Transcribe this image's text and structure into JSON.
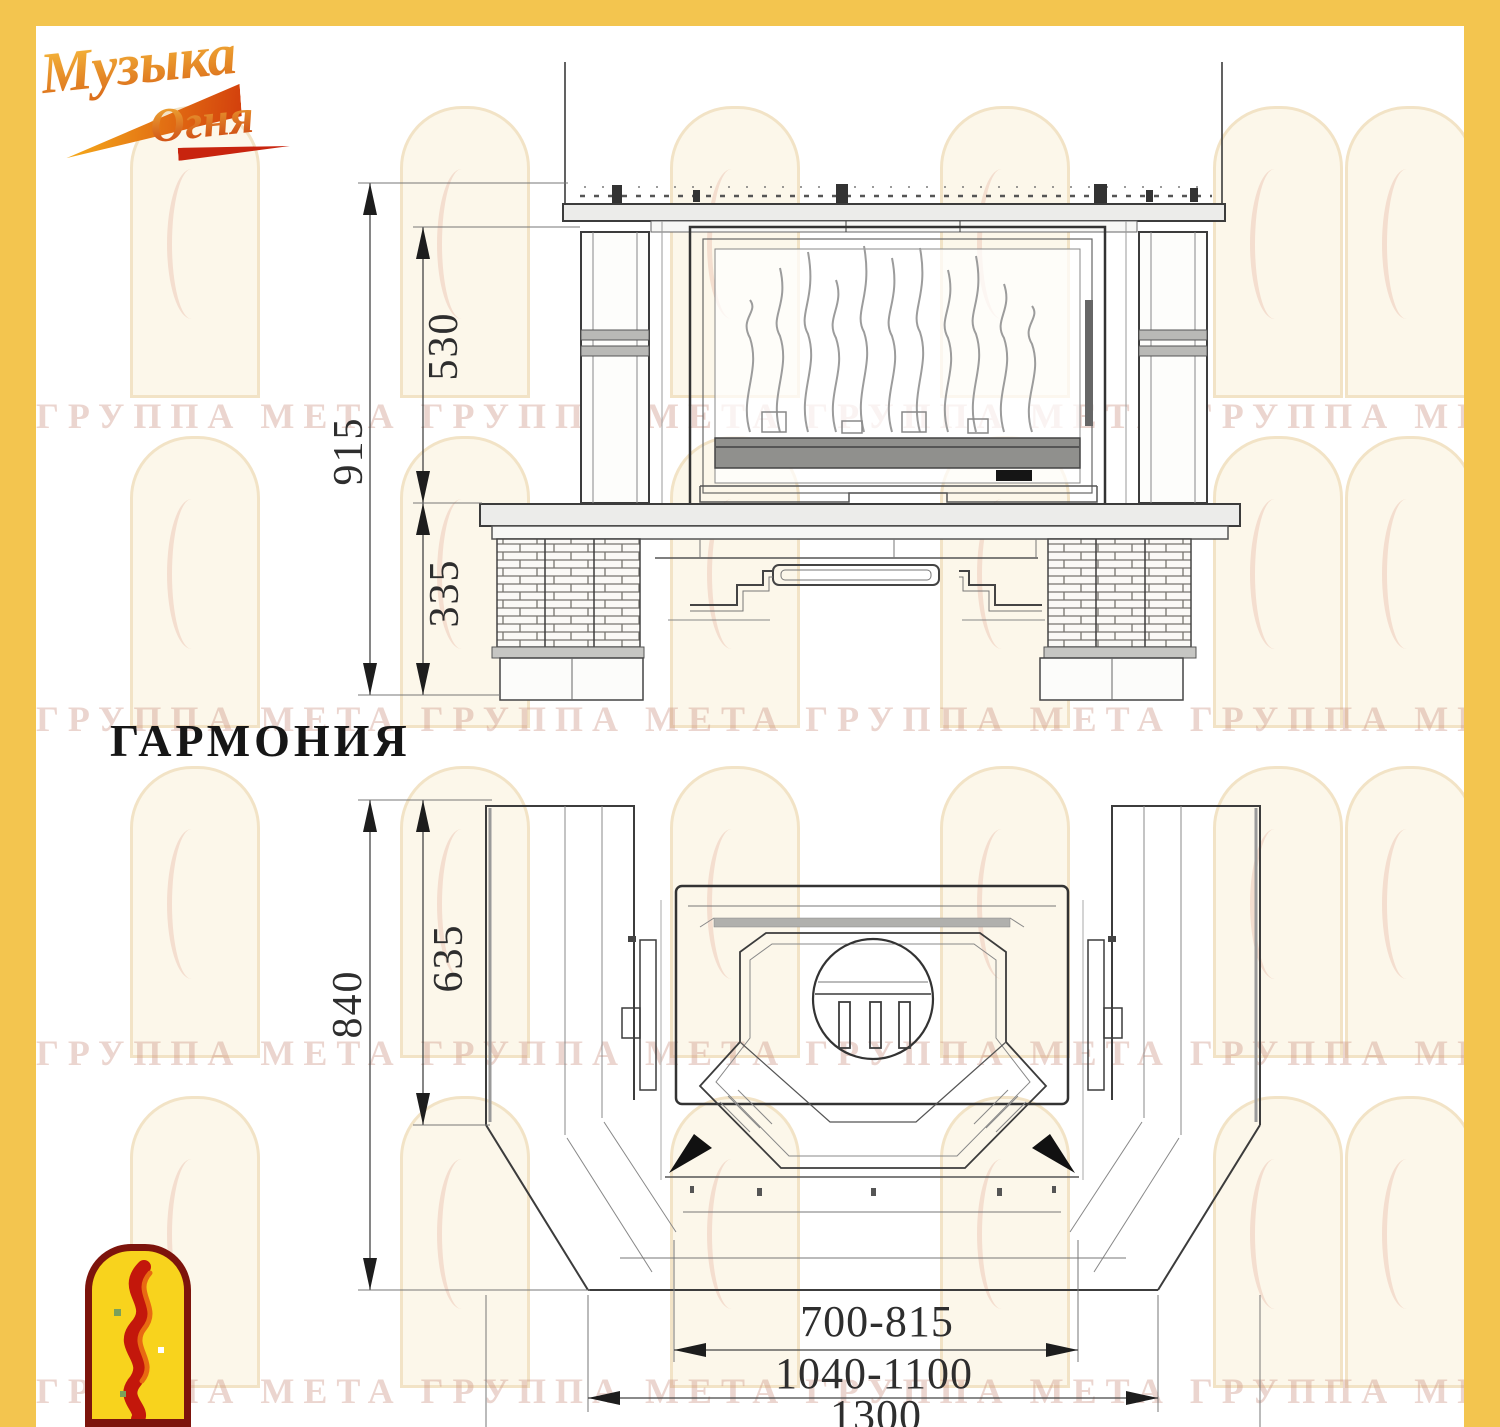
{
  "model": {
    "title": "ГАРМОНИЯ"
  },
  "brand_logo": {
    "word1": "Музыка",
    "word2": "Огня"
  },
  "front_view": {
    "name": "front elevation of fireplace",
    "dimensions": {
      "total_height": "915",
      "firebox_height": "530",
      "base_height": "335"
    }
  },
  "plan_view": {
    "name": "top plan of fireplace",
    "dimensions": {
      "total_depth": "840",
      "wall_depth": "635",
      "firebox_width_range": "700-815",
      "inner_width_range": "1040-1100",
      "total_width": "1300"
    }
  },
  "watermark": {
    "row_text": "ГРУППА МЕТА ГРУППА МЕТА ГРУППА МЕТА ГРУППА МЕТА ГРУППА МЕТА",
    "tile": "arched-window"
  },
  "colors": {
    "frame_yellow": "#F3C54F",
    "logo_orange": "#E07E14",
    "logo_red": "#C5270F",
    "logo_yellow": "#F8D31D",
    "arch_fill": "#FCF7EA",
    "arch_border": "#F2E3C6",
    "drawing_line": "#3C3C3C",
    "grate_gray": "#90908D",
    "watermark_text": "#CB9182"
  }
}
